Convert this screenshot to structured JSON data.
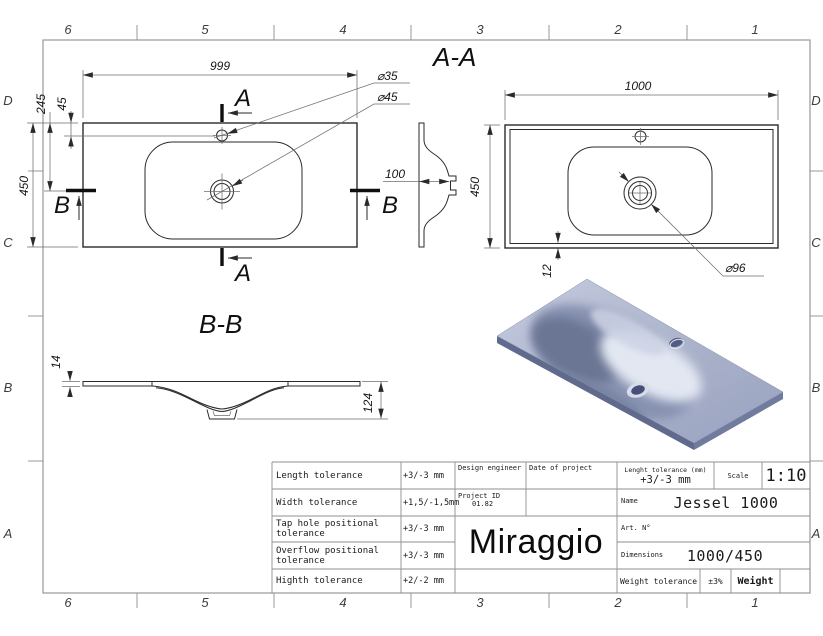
{
  "sheet": {
    "grid_cols": [
      "6",
      "5",
      "4",
      "3",
      "2",
      "1"
    ],
    "grid_rows": [
      "D",
      "C",
      "B",
      "A"
    ]
  },
  "views": {
    "top": {
      "width": "999",
      "height": "450",
      "tap_offset": "245",
      "tap_edge": "45",
      "tap_dia": "⌀35",
      "drain_dia": "⌀45",
      "cut_a": "A",
      "cut_b": "B"
    },
    "profile": {
      "depth": "100"
    },
    "aa": {
      "title": "A-A",
      "width": "1000",
      "height": "450",
      "rim": "12",
      "overflow_dia": "⌀96"
    },
    "bb": {
      "title": "B-B",
      "thickness": "14",
      "depth": "124"
    }
  },
  "title_block": {
    "rows": [
      {
        "label": "Length tolerance",
        "value": "+3/-3 mm"
      },
      {
        "label": "Width tolerance",
        "value": "+1,5/-1,5mm"
      },
      {
        "label": "Tap hole positional tolerance",
        "value": "+3/-3 mm"
      },
      {
        "label": "Overflow positional tolerance",
        "value": "+3/-3 mm"
      },
      {
        "label": "Highth tolerance",
        "value": "+2/-2 mm"
      }
    ],
    "design_engineer": "Design engineer",
    "date_of_project": "Date of project",
    "project_id_label": "Project ID",
    "project_id_value": "01.82",
    "brand": "Miraggio",
    "length_tol_label": "Lenght tolerance (mm)",
    "length_tol_value": "+3/-3 mm",
    "scale_label": "Scale",
    "scale_value": "1:10",
    "name_label": "Name",
    "name_value": "Jessel 1000",
    "art_label": "Art. N°",
    "dimensions_label": "Dimensions",
    "dimensions_value": "1000/450",
    "weight_tol_label": "Weight tolerance",
    "weight_tol_value": "±3%",
    "weight_label": "Weight"
  },
  "render_colors": {
    "deck_light": "#c6ccdf",
    "deck_dark": "#98a1c0",
    "basin_shadow": "#76819f",
    "basin_highlight": "#e2e7f2",
    "hole_dark": "#4e5a82"
  }
}
